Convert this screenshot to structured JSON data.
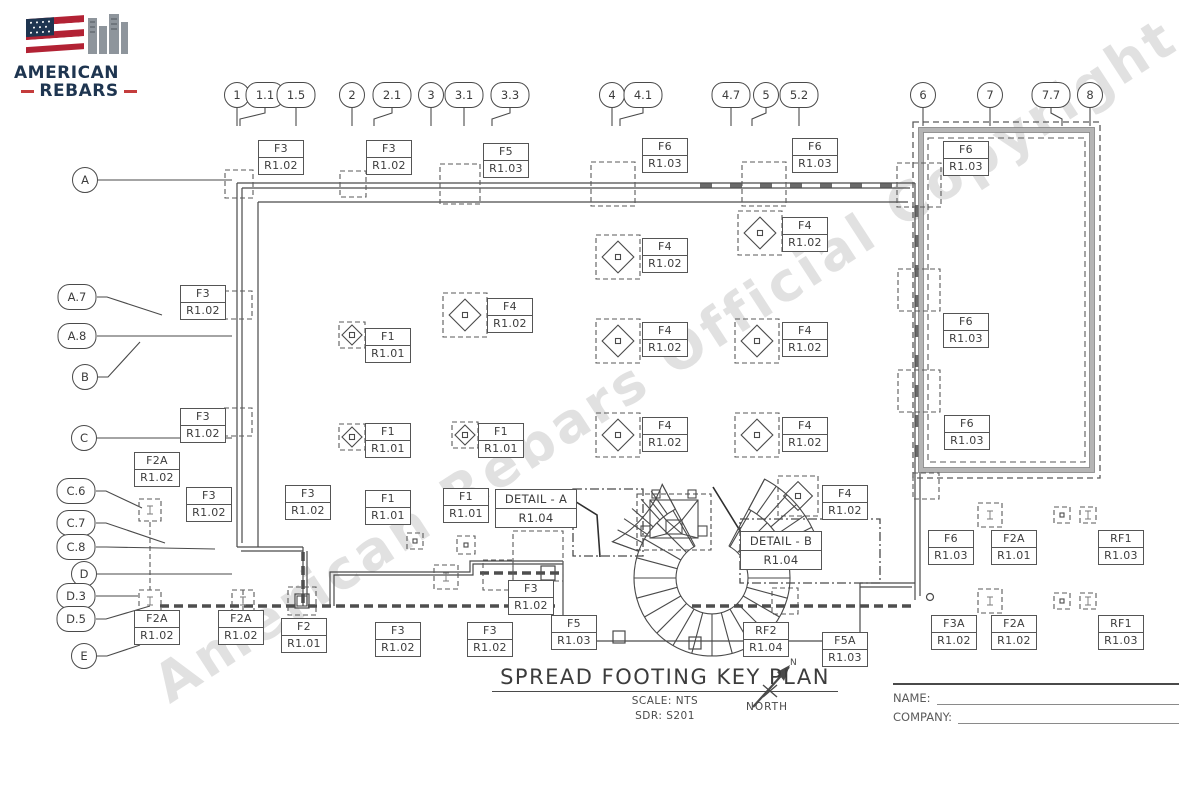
{
  "logo": {
    "line1": "AMERICAN",
    "line2": "REBARS"
  },
  "watermark": "American Rebars Official Copyright",
  "title_block": {
    "title": "SPREAD FOOTING KEY PLAN",
    "scale": "SCALE: NTS",
    "sdr": "SDR: S201",
    "north_n": "N",
    "north_label": "NORTH"
  },
  "signature": {
    "name_label": "NAME:",
    "company_label": "COMPANY:"
  },
  "grid": {
    "columns": [
      {
        "label": "1",
        "x": 237,
        "y": 95
      },
      {
        "label": "1.1",
        "x": 265,
        "y": 95,
        "to": 240
      },
      {
        "label": "1.5",
        "x": 296,
        "y": 95
      },
      {
        "label": "2",
        "x": 352,
        "y": 95
      },
      {
        "label": "2.1",
        "x": 392,
        "y": 95,
        "to": 374
      },
      {
        "label": "3",
        "x": 431,
        "y": 95
      },
      {
        "label": "3.1",
        "x": 464,
        "y": 95
      },
      {
        "label": "3.3",
        "x": 510,
        "y": 95,
        "to": 492
      },
      {
        "label": "4",
        "x": 612,
        "y": 95
      },
      {
        "label": "4.1",
        "x": 643,
        "y": 95,
        "to": 620
      },
      {
        "label": "4.7",
        "x": 731,
        "y": 95
      },
      {
        "label": "5",
        "x": 766,
        "y": 95,
        "to": 752
      },
      {
        "label": "5.2",
        "x": 799,
        "y": 95
      },
      {
        "label": "6",
        "x": 923,
        "y": 95
      },
      {
        "label": "7",
        "x": 990,
        "y": 95
      },
      {
        "label": "7.7",
        "x": 1051,
        "y": 95,
        "to": 1062
      },
      {
        "label": "8",
        "x": 1090,
        "y": 95
      }
    ],
    "rows": [
      {
        "label": "A",
        "x": 85,
        "y": 180,
        "tx": 232,
        "ty": 180
      },
      {
        "label": "A.7",
        "x": 77,
        "y": 297,
        "tx": 162,
        "ty": 315
      },
      {
        "label": "A.8",
        "x": 77,
        "y": 336,
        "tx": 232,
        "ty": 336
      },
      {
        "label": "B",
        "x": 85,
        "y": 377,
        "tx": 140,
        "ty": 342
      },
      {
        "label": "C",
        "x": 84,
        "y": 438,
        "tx": 232,
        "ty": 438
      },
      {
        "label": "C.6",
        "x": 76,
        "y": 491,
        "tx": 142,
        "ty": 508
      },
      {
        "label": "C.7",
        "x": 76,
        "y": 523,
        "tx": 165,
        "ty": 543
      },
      {
        "label": "C.8",
        "x": 76,
        "y": 547,
        "tx": 215,
        "ty": 549
      },
      {
        "label": "D",
        "x": 84,
        "y": 574,
        "tx": 232,
        "ty": 574
      },
      {
        "label": "D.3",
        "x": 76,
        "y": 596,
        "tx": 138,
        "ty": 596
      },
      {
        "label": "D.5",
        "x": 76,
        "y": 619,
        "tx": 150,
        "ty": 606
      },
      {
        "label": "E",
        "x": 84,
        "y": 656,
        "tx": 140,
        "ty": 645
      }
    ]
  },
  "footing_tags": [
    {
      "label": "F3",
      "ref": "R1.02",
      "x": 258,
      "y": 140
    },
    {
      "label": "F3",
      "ref": "R1.02",
      "x": 366,
      "y": 140
    },
    {
      "label": "F5",
      "ref": "R1.03",
      "x": 483,
      "y": 143
    },
    {
      "label": "F6",
      "ref": "R1.03",
      "x": 642,
      "y": 138
    },
    {
      "label": "F6",
      "ref": "R1.03",
      "x": 792,
      "y": 138
    },
    {
      "label": "F6",
      "ref": "R1.03",
      "x": 943,
      "y": 141
    },
    {
      "label": "F4",
      "ref": "R1.02",
      "x": 782,
      "y": 217
    },
    {
      "label": "F4",
      "ref": "R1.02",
      "x": 642,
      "y": 238
    },
    {
      "label": "F3",
      "ref": "R1.02",
      "x": 180,
      "y": 285
    },
    {
      "label": "F4",
      "ref": "R1.02",
      "x": 487,
      "y": 298
    },
    {
      "label": "F1",
      "ref": "R1.01",
      "x": 365,
      "y": 328
    },
    {
      "label": "F4",
      "ref": "R1.02",
      "x": 642,
      "y": 322
    },
    {
      "label": "F4",
      "ref": "R1.02",
      "x": 782,
      "y": 322
    },
    {
      "label": "F6",
      "ref": "R1.03",
      "x": 943,
      "y": 313
    },
    {
      "label": "F3",
      "ref": "R1.02",
      "x": 180,
      "y": 408
    },
    {
      "label": "F1",
      "ref": "R1.01",
      "x": 365,
      "y": 423
    },
    {
      "label": "F1",
      "ref": "R1.01",
      "x": 478,
      "y": 423
    },
    {
      "label": "F4",
      "ref": "R1.02",
      "x": 642,
      "y": 417
    },
    {
      "label": "F4",
      "ref": "R1.02",
      "x": 782,
      "y": 417
    },
    {
      "label": "F6",
      "ref": "R1.03",
      "x": 944,
      "y": 415
    },
    {
      "label": "F2A",
      "ref": "R1.02",
      "x": 134,
      "y": 452
    },
    {
      "label": "F3",
      "ref": "R1.02",
      "x": 186,
      "y": 487
    },
    {
      "label": "F3",
      "ref": "R1.02",
      "x": 285,
      "y": 485
    },
    {
      "label": "F1",
      "ref": "R1.01",
      "x": 365,
      "y": 490
    },
    {
      "label": "F1",
      "ref": "R1.01",
      "x": 443,
      "y": 488
    },
    {
      "label": "F4",
      "ref": "R1.02",
      "x": 822,
      "y": 485
    },
    {
      "label": "F6",
      "ref": "R1.03",
      "x": 928,
      "y": 530
    },
    {
      "label": "F2A",
      "ref": "R1.01",
      "x": 991,
      "y": 530
    },
    {
      "label": "RF1",
      "ref": "R1.03",
      "x": 1098,
      "y": 530
    },
    {
      "label": "F3",
      "ref": "R1.02",
      "x": 508,
      "y": 580
    },
    {
      "label": "F2A",
      "ref": "R1.02",
      "x": 134,
      "y": 610
    },
    {
      "label": "F2A",
      "ref": "R1.02",
      "x": 218,
      "y": 610
    },
    {
      "label": "F2",
      "ref": "R1.01",
      "x": 281,
      "y": 618
    },
    {
      "label": "F3",
      "ref": "R1.02",
      "x": 375,
      "y": 622
    },
    {
      "label": "F3",
      "ref": "R1.02",
      "x": 467,
      "y": 622
    },
    {
      "label": "F5",
      "ref": "R1.03",
      "x": 551,
      "y": 615
    },
    {
      "label": "RF2",
      "ref": "R1.04",
      "x": 743,
      "y": 622
    },
    {
      "label": "F5A",
      "ref": "R1.03",
      "x": 822,
      "y": 632
    },
    {
      "label": "F3A",
      "ref": "R1.02",
      "x": 931,
      "y": 615
    },
    {
      "label": "F2A",
      "ref": "R1.02",
      "x": 991,
      "y": 615
    },
    {
      "label": "RF1",
      "ref": "R1.03",
      "x": 1098,
      "y": 615
    }
  ],
  "detail_callouts": [
    {
      "label": "DETAIL - A",
      "ref": "R1.04",
      "x": 495,
      "y": 489,
      "w": 80
    },
    {
      "label": "DETAIL - B",
      "ref": "R1.04",
      "x": 740,
      "y": 531,
      "w": 80
    }
  ],
  "symbols": {
    "diamonds": [
      {
        "x": 618,
        "y": 257,
        "s": 44
      },
      {
        "x": 760,
        "y": 233,
        "s": 44
      },
      {
        "x": 465,
        "y": 315,
        "s": 44
      },
      {
        "x": 352,
        "y": 335,
        "s": 26
      },
      {
        "x": 618,
        "y": 341,
        "s": 44
      },
      {
        "x": 757,
        "y": 341,
        "s": 44
      },
      {
        "x": 352,
        "y": 437,
        "s": 26
      },
      {
        "x": 465,
        "y": 435,
        "s": 26
      },
      {
        "x": 618,
        "y": 435,
        "s": 44
      },
      {
        "x": 757,
        "y": 435,
        "s": 44
      },
      {
        "x": 798,
        "y": 496,
        "s": 40
      }
    ],
    "wall_squares": [
      {
        "x": 239,
        "y": 184,
        "s": 28
      },
      {
        "x": 353,
        "y": 184,
        "s": 26
      },
      {
        "x": 460,
        "y": 184,
        "s": 40
      },
      {
        "x": 613,
        "y": 184,
        "s": 44
      },
      {
        "x": 764,
        "y": 184,
        "s": 44
      },
      {
        "x": 919,
        "y": 185,
        "s": 44
      },
      {
        "x": 238,
        "y": 305,
        "s": 28
      },
      {
        "x": 238,
        "y": 422,
        "s": 28
      },
      {
        "x": 919,
        "y": 290,
        "s": 42
      },
      {
        "x": 919,
        "y": 391,
        "s": 42
      },
      {
        "x": 926,
        "y": 486,
        "s": 26
      },
      {
        "x": 538,
        "y": 556,
        "s": 50
      },
      {
        "x": 498,
        "y": 575,
        "s": 30
      },
      {
        "x": 785,
        "y": 601,
        "s": 26
      }
    ],
    "i_squares": [
      {
        "x": 150,
        "y": 510,
        "s": 22,
        "g": "I"
      },
      {
        "x": 150,
        "y": 601,
        "s": 22,
        "g": "I"
      },
      {
        "x": 243,
        "y": 601,
        "s": 22,
        "g": "I"
      },
      {
        "x": 302,
        "y": 601,
        "s": 28,
        "g": "sq"
      },
      {
        "x": 446,
        "y": 577,
        "s": 24,
        "g": "I"
      },
      {
        "x": 466,
        "y": 545,
        "s": 18,
        "g": "dot"
      },
      {
        "x": 415,
        "y": 541,
        "s": 16,
        "g": "dot"
      },
      {
        "x": 990,
        "y": 515,
        "s": 24,
        "g": "I"
      },
      {
        "x": 990,
        "y": 601,
        "s": 24,
        "g": "I"
      },
      {
        "x": 1062,
        "y": 515,
        "s": 16,
        "g": "dot"
      },
      {
        "x": 1088,
        "y": 515,
        "s": 16,
        "g": "I"
      },
      {
        "x": 1062,
        "y": 601,
        "s": 16,
        "g": "dot"
      },
      {
        "x": 1088,
        "y": 601,
        "s": 16,
        "g": "I"
      }
    ]
  },
  "colors": {
    "line": "#4a4a4a",
    "dash": "#5a5a5a",
    "annex_gray": "#b5b5b5",
    "watermark": "#c9c9c9",
    "logo_navy": "#1e3550",
    "logo_red": "#c43c3c"
  }
}
